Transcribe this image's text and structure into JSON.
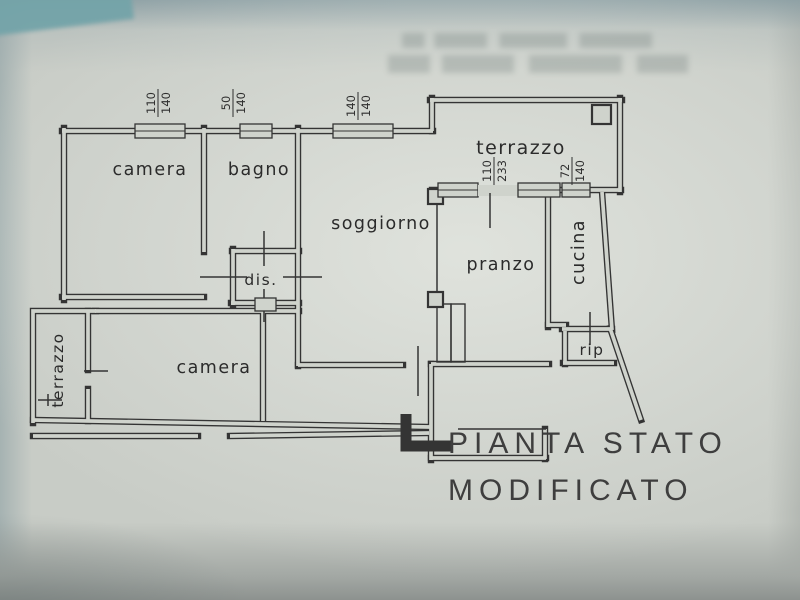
{
  "photo": {
    "paper_color": "#c8ccc6",
    "paper_highlight": "#cfd3cc",
    "ink_color": "#343434",
    "corner_teal": "#74a4a9"
  },
  "plan": {
    "rooms": [
      {
        "id": "camera-1",
        "label": "camera"
      },
      {
        "id": "bagno",
        "label": "bagno"
      },
      {
        "id": "soggiorno",
        "label": "soggiorno"
      },
      {
        "id": "terrazzo-top",
        "label": "terrazzo"
      },
      {
        "id": "pranzo",
        "label": "pranzo"
      },
      {
        "id": "cucina",
        "label": "cucina"
      },
      {
        "id": "rip",
        "label": "rip"
      },
      {
        "id": "dis",
        "label": "dis."
      },
      {
        "id": "camera-2",
        "label": "camera"
      },
      {
        "id": "terrazzo-left",
        "label": "terrazzo"
      }
    ],
    "dimensions": [
      {
        "id": "window-camera",
        "num": "110",
        "den": "140"
      },
      {
        "id": "window-bagno",
        "num": "50",
        "den": "140"
      },
      {
        "id": "window-soggiorno",
        "num": "140",
        "den": "140"
      },
      {
        "id": "door-pranzo",
        "num": "110",
        "den": "233"
      },
      {
        "id": "window-cucina",
        "num": "72",
        "den": "140"
      }
    ],
    "title_line1": "PIANTA STATO",
    "title_line2": "MODIFICATO"
  }
}
